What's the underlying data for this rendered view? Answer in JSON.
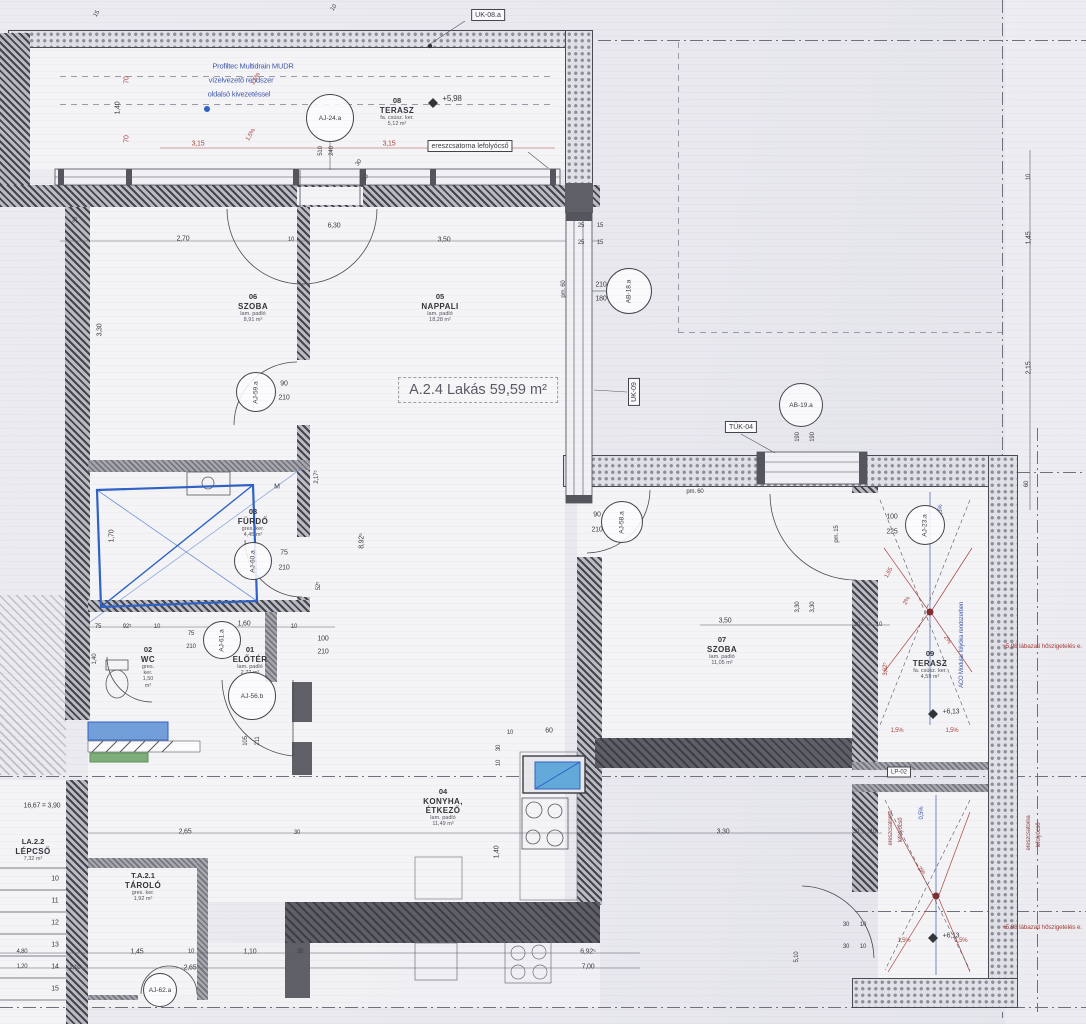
{
  "apartment_label": "A.2.4 Lakás 59,59 m²",
  "colors": {
    "ink": "#3b3b42",
    "red": "#a8443e",
    "red_dark": "#8c4a4e",
    "blue": "#4058a8",
    "hand_blue": "#2f62c4",
    "green": "#7fae7a",
    "sink_blue": "#63a9da"
  },
  "rooms": [
    {
      "num": "06",
      "name": "SZOBA",
      "sub": "lam. padló",
      "area": "8,91 m²",
      "x": 253,
      "y": 293
    },
    {
      "num": "05",
      "name": "NAPPALI",
      "sub": "lam. padló",
      "area": "18,28 m²",
      "x": 440,
      "y": 293
    },
    {
      "num": "08",
      "name": "TERASZ",
      "sub": "fa. csúsz. ker.",
      "area": "5,12 m²",
      "x": 397,
      "y": 97
    },
    {
      "num": "03",
      "name": "FÜRDŐ",
      "sub": "gres. ker.",
      "area": "4,45 m²",
      "x": 253,
      "y": 508
    },
    {
      "num": "02",
      "name": "WC",
      "sub": "gres. ker.",
      "area": "1,50 m²",
      "x": 148,
      "y": 646
    },
    {
      "num": "01",
      "name": "ELŐTÉR",
      "sub": "lam. padló",
      "area": "2,77 m²",
      "x": 250,
      "y": 646
    },
    {
      "num": "04",
      "name": "KONYHA, ÉTKEZŐ",
      "sub": "lam. padló",
      "area": "11,49 m²",
      "x": 443,
      "y": 788
    },
    {
      "num": "07",
      "name": "SZOBA",
      "sub": "lam. padló",
      "area": "11,05 m²",
      "x": 722,
      "y": 636
    },
    {
      "num": "09",
      "name": "TERASZ",
      "sub": "fa. csúsz. ker.",
      "area": "4,59 m²",
      "x": 930,
      "y": 650
    },
    {
      "num": "T.A.2.1",
      "name": "TÁROLÓ",
      "sub": "gres. ker.",
      "area": "1,92 m²",
      "x": 143,
      "y": 872
    },
    {
      "num": "LA.2.2",
      "name": "LÉPCSŐ",
      "sub": "",
      "area": "7,32 m²",
      "x": 33,
      "y": 838
    }
  ],
  "tags": [
    {
      "l": "AJ-24.a",
      "x": 330,
      "y": 118,
      "r": 24,
      "v": 0
    },
    {
      "l": "AJ-59.a",
      "x": 256,
      "y": 392,
      "r": 20,
      "v": 1
    },
    {
      "l": "AJ-60.a",
      "x": 253,
      "y": 561,
      "r": 19,
      "v": 1
    },
    {
      "l": "AJ-61.a",
      "x": 222,
      "y": 640,
      "r": 19,
      "v": 1
    },
    {
      "l": "AJ-56.b",
      "x": 252,
      "y": 696,
      "r": 24,
      "v": 0
    },
    {
      "l": "AJ-58.a",
      "x": 622,
      "y": 522,
      "r": 21,
      "v": 1
    },
    {
      "l": "AJ-23.a",
      "x": 925,
      "y": 525,
      "r": 20,
      "v": 1
    },
    {
      "l": "AB-18.a",
      "x": 629,
      "y": 291,
      "r": 23,
      "v": 1
    },
    {
      "l": "AB-19.a",
      "x": 801,
      "y": 405,
      "r": 22,
      "v": 0
    },
    {
      "l": "AJ-62.a",
      "x": 160,
      "y": 990,
      "r": 17,
      "v": 0
    }
  ],
  "boxes": [
    {
      "l": "UK-08.a",
      "x": 488,
      "y": 15,
      "v": 0,
      "f": 7
    },
    {
      "l": "UK-09",
      "x": 634,
      "y": 392,
      "v": 1,
      "f": 7
    },
    {
      "l": "TÜK-04",
      "x": 741,
      "y": 427,
      "v": 0,
      "f": 7
    },
    {
      "l": "LP-02",
      "x": 899,
      "y": 772,
      "v": 0,
      "f": 6
    },
    {
      "l": "ereszcsatorna lefolyócső",
      "x": 470,
      "y": 146,
      "v": 0,
      "f": 7
    }
  ],
  "steps": [
    "10",
    "11",
    "12",
    "13",
    "14",
    "15"
  ],
  "texts": [
    {
      "t": "Profiltec Multidrain MUDR",
      "x": 253,
      "y": 66,
      "c": "b",
      "f": 7.5
    },
    {
      "t": "vízelvezető rendszer",
      "x": 241,
      "y": 80,
      "c": "b",
      "f": 7.5
    },
    {
      "t": "oldalsó kivezetéssel",
      "x": 239,
      "y": 94,
      "c": "b",
      "f": 7.5
    },
    {
      "t": "1,5%",
      "x": 256,
      "y": 79,
      "r": -60,
      "c": "r",
      "f": 6
    },
    {
      "t": "1,5%",
      "x": 251,
      "y": 135,
      "r": -60,
      "c": "r",
      "f": 6
    },
    {
      "t": "70",
      "x": 127,
      "y": 80,
      "r": -90,
      "c": "r",
      "f": 7
    },
    {
      "t": "1,40",
      "x": 118,
      "y": 108,
      "r": -90,
      "f": 7
    },
    {
      "t": "70",
      "x": 127,
      "y": 139,
      "r": -90,
      "c": "r",
      "f": 7
    },
    {
      "t": "3,15",
      "x": 198,
      "y": 144,
      "c": "r",
      "f": 7
    },
    {
      "t": "3,15",
      "x": 389,
      "y": 144,
      "c": "r",
      "f": 7
    },
    {
      "t": "510",
      "x": 321,
      "y": 151,
      "r": -90,
      "f": 6
    },
    {
      "t": "240",
      "x": 332,
      "y": 151,
      "r": -90,
      "f": 6
    },
    {
      "t": "30",
      "x": 359,
      "y": 163,
      "r": -55,
      "f": 6
    },
    {
      "t": "10",
      "x": 366,
      "y": 178,
      "r": -55,
      "f": 6
    },
    {
      "t": "+5,98",
      "x": 452,
      "y": 99,
      "f": 8
    },
    {
      "t": "15",
      "x": 97,
      "y": 14,
      "r": -60,
      "f": 6
    },
    {
      "t": "10",
      "x": 334,
      "y": 8,
      "r": -55,
      "f": 6
    },
    {
      "t": "2,70",
      "x": 183,
      "y": 239,
      "f": 7
    },
    {
      "t": "10",
      "x": 291,
      "y": 240,
      "f": 6
    },
    {
      "t": "6,30",
      "x": 334,
      "y": 226,
      "f": 7
    },
    {
      "t": "3,50",
      "x": 444,
      "y": 240,
      "f": 7
    },
    {
      "t": "25",
      "x": 581,
      "y": 226,
      "f": 6
    },
    {
      "t": "15",
      "x": 600,
      "y": 226,
      "f": 6
    },
    {
      "t": "25",
      "x": 581,
      "y": 243,
      "f": 6
    },
    {
      "t": "15",
      "x": 600,
      "y": 243,
      "f": 6
    },
    {
      "t": "30",
      "x": 76,
      "y": 220,
      "r": -90,
      "f": 6
    },
    {
      "t": "3,30",
      "x": 100,
      "y": 330,
      "r": -90,
      "f": 7
    },
    {
      "t": "1,70",
      "x": 112,
      "y": 536,
      "r": -90,
      "f": 7
    },
    {
      "t": "1,40",
      "x": 95,
      "y": 659,
      "r": -90,
      "f": 6
    },
    {
      "t": "2,17⁵",
      "x": 317,
      "y": 477,
      "r": -90,
      "f": 6
    },
    {
      "t": "8,92⁵",
      "x": 362,
      "y": 541,
      "r": -90,
      "f": 7
    },
    {
      "t": "52⁵",
      "x": 319,
      "y": 586,
      "r": -90,
      "f": 6
    },
    {
      "t": "M",
      "x": 277,
      "y": 487,
      "f": 7
    },
    {
      "t": "210",
      "x": 601,
      "y": 285,
      "f": 7
    },
    {
      "t": "180",
      "x": 601,
      "y": 299,
      "f": 7
    },
    {
      "t": "pm. 60",
      "x": 564,
      "y": 289,
      "r": -90,
      "f": 6
    },
    {
      "t": "75",
      "x": 98,
      "y": 627,
      "f": 6
    },
    {
      "t": "92⁵",
      "x": 127,
      "y": 627,
      "f": 6
    },
    {
      "t": "10",
      "x": 157,
      "y": 627,
      "f": 6
    },
    {
      "t": "75",
      "x": 191,
      "y": 634,
      "f": 6
    },
    {
      "t": "210",
      "x": 191,
      "y": 647,
      "f": 6
    },
    {
      "t": "1,60",
      "x": 244,
      "y": 624,
      "f": 7
    },
    {
      "t": "10",
      "x": 294,
      "y": 627,
      "f": 6
    },
    {
      "t": "100",
      "x": 323,
      "y": 639,
      "f": 7
    },
    {
      "t": "210",
      "x": 323,
      "y": 652,
      "f": 7
    },
    {
      "t": "105",
      "x": 246,
      "y": 741,
      "r": -90,
      "f": 6
    },
    {
      "t": "211",
      "x": 258,
      "y": 741,
      "r": -90,
      "f": 6
    },
    {
      "t": "75",
      "x": 284,
      "y": 553,
      "f": 7
    },
    {
      "t": "210",
      "x": 284,
      "y": 568,
      "f": 7
    },
    {
      "t": "90",
      "x": 284,
      "y": 384,
      "f": 7
    },
    {
      "t": "210",
      "x": 284,
      "y": 398,
      "f": 7
    },
    {
      "t": "90",
      "x": 597,
      "y": 515,
      "f": 7
    },
    {
      "t": "210",
      "x": 597,
      "y": 530,
      "f": 7
    },
    {
      "t": "100",
      "x": 892,
      "y": 517,
      "f": 7
    },
    {
      "t": "225",
      "x": 892,
      "y": 532,
      "f": 7
    },
    {
      "t": "10",
      "x": 510,
      "y": 733,
      "f": 6
    },
    {
      "t": "60",
      "x": 549,
      "y": 731,
      "f": 7
    },
    {
      "t": "30",
      "x": 499,
      "y": 748,
      "r": -90,
      "f": 6
    },
    {
      "t": "10",
      "x": 499,
      "y": 763,
      "r": -90,
      "f": 6
    },
    {
      "t": "1,40",
      "x": 497,
      "y": 852,
      "r": -90,
      "f": 7
    },
    {
      "t": "2,65",
      "x": 185,
      "y": 832,
      "f": 7
    },
    {
      "t": "30",
      "x": 297,
      "y": 833,
      "f": 6
    },
    {
      "t": "3,30",
      "x": 723,
      "y": 832,
      "f": 7
    },
    {
      "t": "30",
      "x": 856,
      "y": 832,
      "f": 6
    },
    {
      "t": "10",
      "x": 873,
      "y": 832,
      "f": 6
    },
    {
      "t": "3,50",
      "x": 725,
      "y": 621,
      "f": 7
    },
    {
      "t": "3,30",
      "x": 798,
      "y": 607,
      "r": -90,
      "f": 6
    },
    {
      "t": "3,30",
      "x": 813,
      "y": 607,
      "r": -90,
      "f": 6
    },
    {
      "t": "30",
      "x": 857,
      "y": 625,
      "f": 6
    },
    {
      "t": "10",
      "x": 879,
      "y": 625,
      "f": 6
    },
    {
      "t": "pm. 15",
      "x": 837,
      "y": 534,
      "r": -90,
      "f": 6
    },
    {
      "t": "pm. 60",
      "x": 695,
      "y": 492,
      "f": 6
    },
    {
      "t": "190",
      "x": 798,
      "y": 437,
      "r": -90,
      "f": 6
    },
    {
      "t": "190",
      "x": 813,
      "y": 437,
      "r": -90,
      "f": 6
    },
    {
      "t": "0,5%",
      "x": 941,
      "y": 511,
      "r": -90,
      "c": "b",
      "f": 6
    },
    {
      "t": "1,65",
      "x": 889,
      "y": 573,
      "r": -62,
      "c": "r",
      "f": 6
    },
    {
      "t": "2%",
      "x": 907,
      "y": 601,
      "r": -62,
      "c": "r",
      "f": 6
    },
    {
      "t": "2%",
      "x": 947,
      "y": 640,
      "r": 55,
      "c": "r",
      "f": 6
    },
    {
      "t": "3,62⁵",
      "x": 886,
      "y": 669,
      "r": -90,
      "c": "r",
      "f": 6
    },
    {
      "t": "1,5%",
      "x": 897,
      "y": 731,
      "c": "r",
      "f": 6
    },
    {
      "t": "1,5%",
      "x": 952,
      "y": 731,
      "c": "r",
      "f": 6
    },
    {
      "t": "+6,13",
      "x": 951,
      "y": 712,
      "f": 7
    },
    {
      "t": "ACO Modular folyóka rendszerben",
      "x": 962,
      "y": 645,
      "r": -90,
      "c": "b",
      "f": 6
    },
    {
      "t": "10",
      "x": 1029,
      "y": 177,
      "r": -90,
      "f": 6
    },
    {
      "t": "1,45",
      "x": 1029,
      "y": 238,
      "r": -90,
      "f": 7
    },
    {
      "t": "2,15",
      "x": 1029,
      "y": 368,
      "r": -90,
      "f": 7
    },
    {
      "t": "60",
      "x": 1027,
      "y": 484,
      "r": -90,
      "f": 6
    },
    {
      "t": "+5,98 lábazati hőszigetelés e.",
      "x": 1042,
      "y": 647,
      "c": "r",
      "f": 6.5
    },
    {
      "t": "+5,98 lábazati hőszigetelés e.",
      "x": 1042,
      "y": 928,
      "c": "r",
      "f": 6.5
    },
    {
      "t": "0,5%",
      "x": 922,
      "y": 813,
      "r": -90,
      "c": "b",
      "f": 6
    },
    {
      "t": "ereszcsatorna",
      "x": 891,
      "y": 828,
      "r": -90,
      "c": "r2",
      "f": 6
    },
    {
      "t": "lefolyócső",
      "x": 901,
      "y": 830,
      "r": -90,
      "c": "r2",
      "f": 6
    },
    {
      "t": "ereszcsatorna",
      "x": 1029,
      "y": 833,
      "r": -90,
      "c": "r2",
      "f": 6
    },
    {
      "t": "lefolyócső",
      "x": 1039,
      "y": 835,
      "r": -90,
      "c": "r2",
      "f": 6
    },
    {
      "t": "2%",
      "x": 921,
      "y": 871,
      "r": 45,
      "c": "r",
      "f": 6
    },
    {
      "t": "1,5%",
      "x": 904,
      "y": 941,
      "c": "r",
      "f": 6
    },
    {
      "t": "1,5%",
      "x": 961,
      "y": 941,
      "c": "r",
      "f": 6
    },
    {
      "t": "+6,13",
      "x": 951,
      "y": 936,
      "f": 7
    },
    {
      "t": "30",
      "x": 846,
      "y": 925,
      "f": 6
    },
    {
      "t": "10",
      "x": 863,
      "y": 925,
      "f": 6
    },
    {
      "t": "30",
      "x": 846,
      "y": 947,
      "f": 6
    },
    {
      "t": "10",
      "x": 863,
      "y": 947,
      "f": 6
    },
    {
      "t": "5,10",
      "x": 797,
      "y": 957,
      "r": -90,
      "f": 6
    },
    {
      "t": "6,92⁵",
      "x": 588,
      "y": 952,
      "f": 7
    },
    {
      "t": "7,00",
      "x": 588,
      "y": 967,
      "f": 7
    },
    {
      "t": "4,80",
      "x": 22,
      "y": 952,
      "f": 6
    },
    {
      "t": "1,20",
      "x": 22,
      "y": 967,
      "f": 6
    },
    {
      "t": "1,45",
      "x": 137,
      "y": 952,
      "f": 7
    },
    {
      "t": "10",
      "x": 191,
      "y": 952,
      "f": 6
    },
    {
      "t": "1,10",
      "x": 250,
      "y": 952,
      "f": 7
    },
    {
      "t": "2,65",
      "x": 190,
      "y": 968,
      "f": 7
    },
    {
      "t": "2,10",
      "x": 75,
      "y": 968,
      "f": 6
    },
    {
      "t": "30",
      "x": 300,
      "y": 952,
      "f": 6
    },
    {
      "t": "16,67 = 3,90",
      "x": 42,
      "y": 806,
      "f": 7
    }
  ]
}
